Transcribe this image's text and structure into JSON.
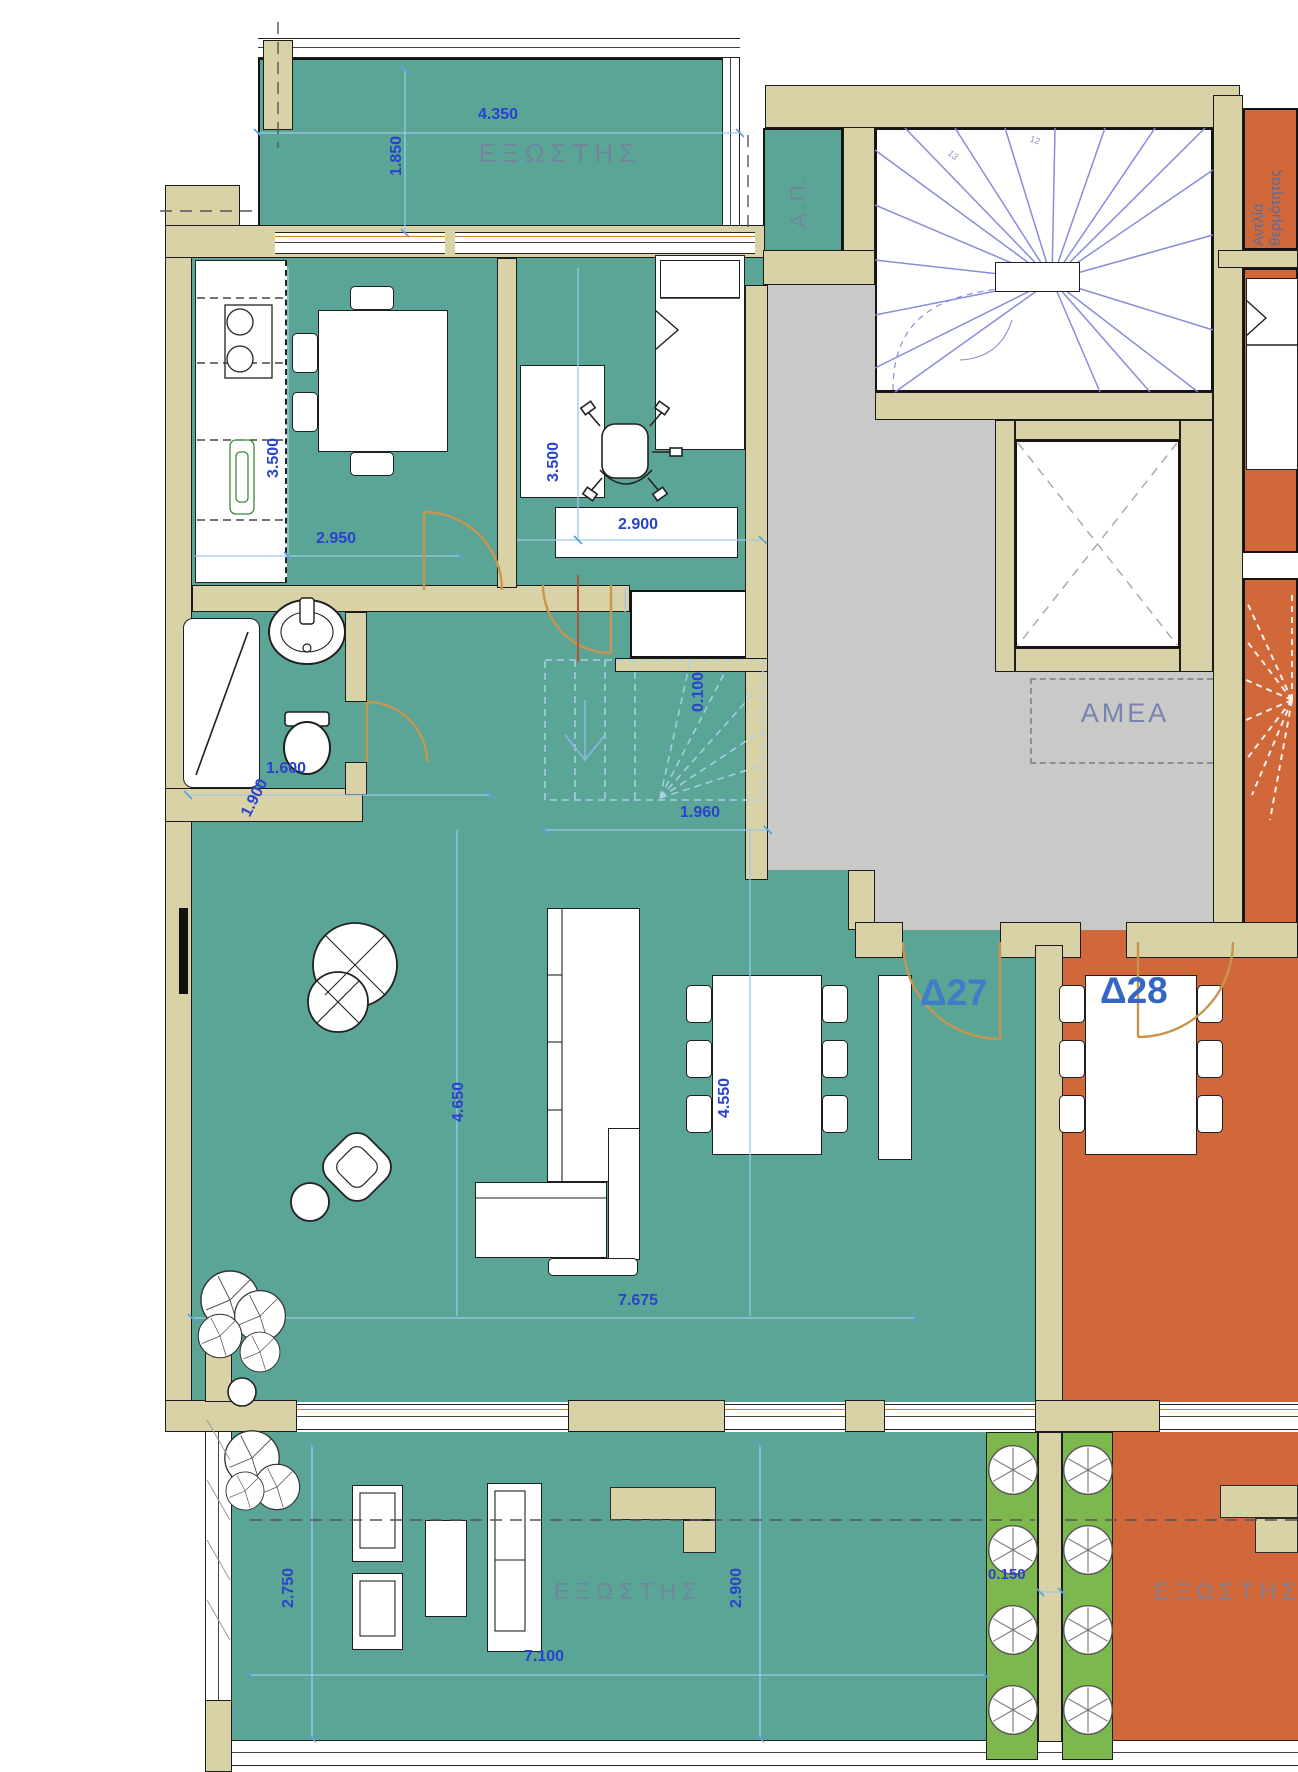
{
  "plan": {
    "units": {
      "left_id": "Δ27",
      "right_id": "Δ28"
    },
    "rooms": {
      "balcony_top_label": "ΕΞΩΣΤΗΣ",
      "ap_label": "Α.Π.",
      "heat_pump_line1": "Αντλία",
      "heat_pump_line2": "θερμότητας",
      "amea_label": "AMEA",
      "balcony_bottom_left_label": "ΕΞΩΣΤΗΣ",
      "balcony_bottom_right_label": "ΕΞΩΣΤΗΣ"
    },
    "dimensions": {
      "balcony_top_width": "4.350",
      "balcony_top_depth": "1.850",
      "kitchen_depth": "3.500",
      "kitchen_width": "2.950",
      "bedroom_depth": "3.500",
      "bedroom_width": "2.900",
      "bathroom_diagonal": "1.900",
      "bathroom_width": "1.600",
      "stair_offset": "0.100",
      "stair_width": "1.960",
      "living_depth_left": "4.650",
      "living_depth_right": "4.550",
      "living_width": "7.675",
      "balcony_bottom_depth_left": "2.750",
      "balcony_bottom_width": "7.100",
      "balcony_bottom_depth_right": "2.900",
      "planter_gap": "0.150"
    },
    "stair_step_numbers": {
      "n1": "12",
      "n2": "13"
    },
    "colors": {
      "apartment_left_floor": "#5aa596",
      "apartment_right_floor": "#d0683a",
      "wall_fill": "#d9d2a6",
      "landing_floor": "#c9c9c7",
      "planter_green": "#7cb84e",
      "dimension_text": "#2a43cf",
      "dimension_line": "#9dc9ea",
      "room_label_text": "#76819f",
      "unit_label_left": "#3f7cc9",
      "unit_label_right": "#3566c5",
      "stair_line": "#8286da",
      "door_arc": "#c8954e",
      "window_accent": "#d4832f"
    }
  }
}
